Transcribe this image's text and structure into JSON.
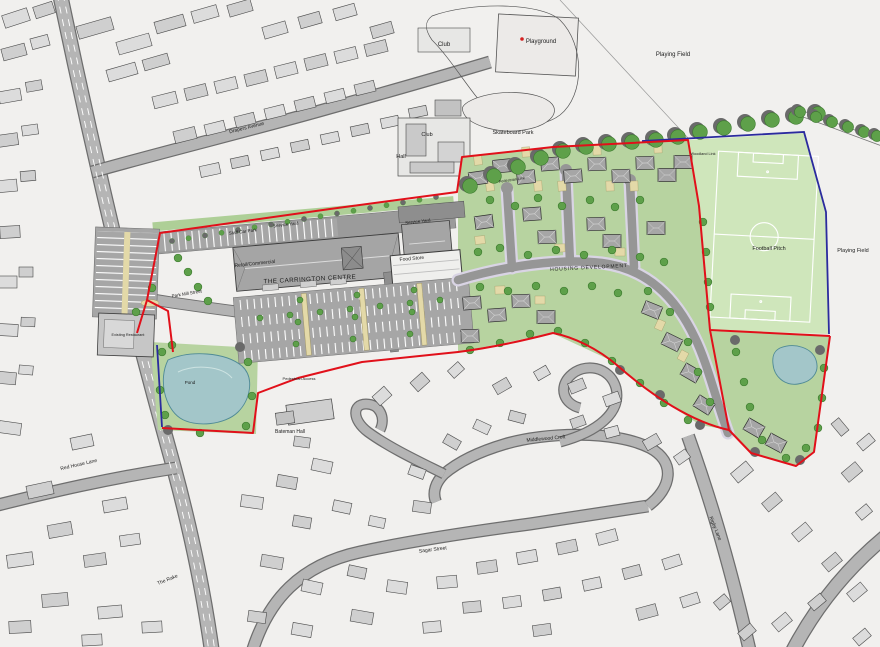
{
  "map": {
    "title": "Site masterplan",
    "labels": {
      "club_top": "Club",
      "playground": "Playground",
      "playing_field_top": "Playing Field",
      "playing_field_east": "Playing Field",
      "skateboard_park": "Skateboard Park",
      "club_hall": "Club",
      "hall": "Hall",
      "drapers_avenue": "Drapers Avenue",
      "pedestrian_link": "Pedestrian Link",
      "woodland_link": "Woodland Link",
      "staff_car_park": "Staff Car Park",
      "service_yard_west": "Service Yard",
      "service_yard_east": "Service Yard",
      "retail_commercial": "Retail/Commercial",
      "food_store": "Food Store",
      "carrington_centre": "THE CARRINGTON CENTRE",
      "park_mill_street": "Park Mill Street",
      "existing_restaurant": "Existing Restaurant",
      "pond": "Pond",
      "pedestrian_access": "Pedestrian Access",
      "bateman_hall": "Bateman Hall",
      "housing_development": "HOUSING DEVELOPMENT",
      "football_pitch": "Football Pitch",
      "middlewood_croft": "Middlewood Croft",
      "sagar_street": "Sagar Street",
      "red_house_lane": "Red House Lane",
      "the_rake": "The Rake",
      "rigby_lane": "Rigby Lane"
    },
    "colors": {
      "boundary_red": "#e1101a",
      "boundary_blue": "#2b2b9e",
      "landscape_green": "#b7d3a0",
      "pitch_green": "#cfe6bb",
      "tree_green": "#5ea04a",
      "tree_outline": "#3b7a2d",
      "tree_shadow": "#6a6a6a",
      "water_blue": "#a3c6c9",
      "water_outline": "#4f8a96",
      "road_gray": "#b5b5b5",
      "housing_road_gray": "#969696",
      "footway_lavender": "#d9d4e4",
      "building_gray": "#dcdcdc",
      "roof_gray": "#a5a5a5",
      "parking_gray": "#a6a6a6",
      "beige_island": "#e3d9a8",
      "maroon_label": "#7b3020"
    }
  }
}
